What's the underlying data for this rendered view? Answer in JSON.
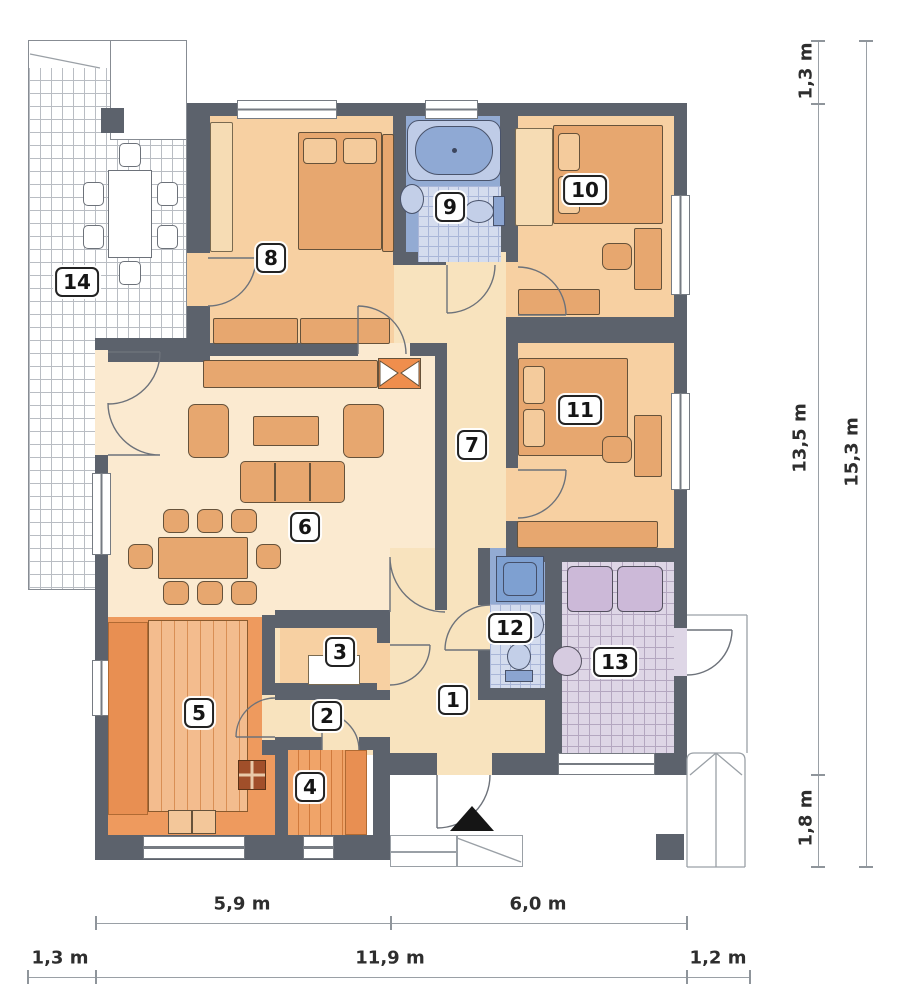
{
  "plan": {
    "type": "architectural-floor-plan",
    "rooms": [
      {
        "number": "1"
      },
      {
        "number": "2"
      },
      {
        "number": "3"
      },
      {
        "number": "4"
      },
      {
        "number": "5"
      },
      {
        "number": "6"
      },
      {
        "number": "7"
      },
      {
        "number": "8"
      },
      {
        "number": "9"
      },
      {
        "number": "10"
      },
      {
        "number": "11"
      },
      {
        "number": "12"
      },
      {
        "number": "13"
      },
      {
        "number": "14"
      }
    ],
    "dimensions": {
      "right_top": "1,3 m",
      "right_house": "13,5 m",
      "right_porch": "1,8 m",
      "right_total": "15,3 m",
      "bottom_left": "5,9 m",
      "bottom_right": "6,0 m",
      "bottom_terrace": "1,3 m",
      "bottom_house": "11,9 m",
      "bottom_side": "1,2 m"
    },
    "colors": {
      "wall": "#5c626c",
      "bedroom_floor": "#f7d0a2",
      "living_floor": "#fbead0",
      "hall_floor": "#f8e3be",
      "bath_floor": "#93abd3",
      "kitchen": "#ee9a5e",
      "utility_tile": "#ded6e6",
      "furniture": "#e7a76f",
      "fireplace_accent": "#ef8e4d"
    }
  }
}
